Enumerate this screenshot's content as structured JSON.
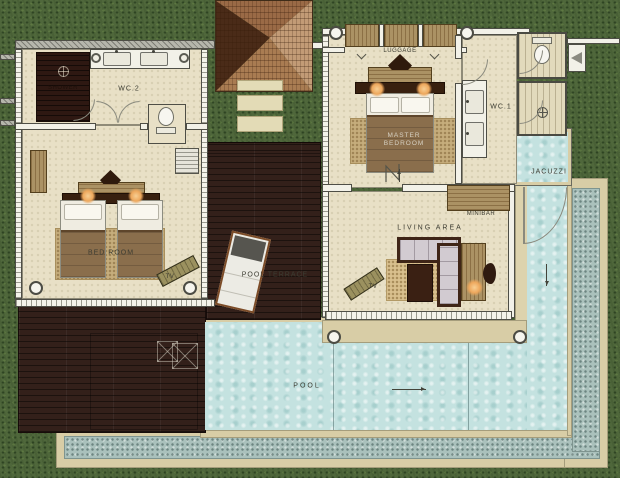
{
  "type": "floor-plan",
  "rooms": {
    "wc2": "WC.2",
    "shower": "SHOWER",
    "bed_room": "BED  ROOM",
    "tv_bed": "TV",
    "pool_terrace": "POOL TERRACE",
    "pool": "POOL",
    "luggage": "LUGGAGE",
    "master_bedroom": "MASTER BEDROOM",
    "wc1": "WC.1",
    "jacuzzi": "JACUZZI",
    "minibar": "MINIBAR",
    "living_area": "LIVING  AREA",
    "tv_living": "TV"
  },
  "colors": {
    "grass": "#4f673b",
    "floor": "#e8e0c6",
    "deck": "#33201a",
    "water": "#c4e2e0",
    "pebble": "#aac1bc",
    "coping": "#d8cda6",
    "wall": "#f2f1e8",
    "wood": "#ab9264",
    "blanket": "#8a6e4c",
    "lamp": "#eda75c",
    "label": "#3c3c32"
  }
}
